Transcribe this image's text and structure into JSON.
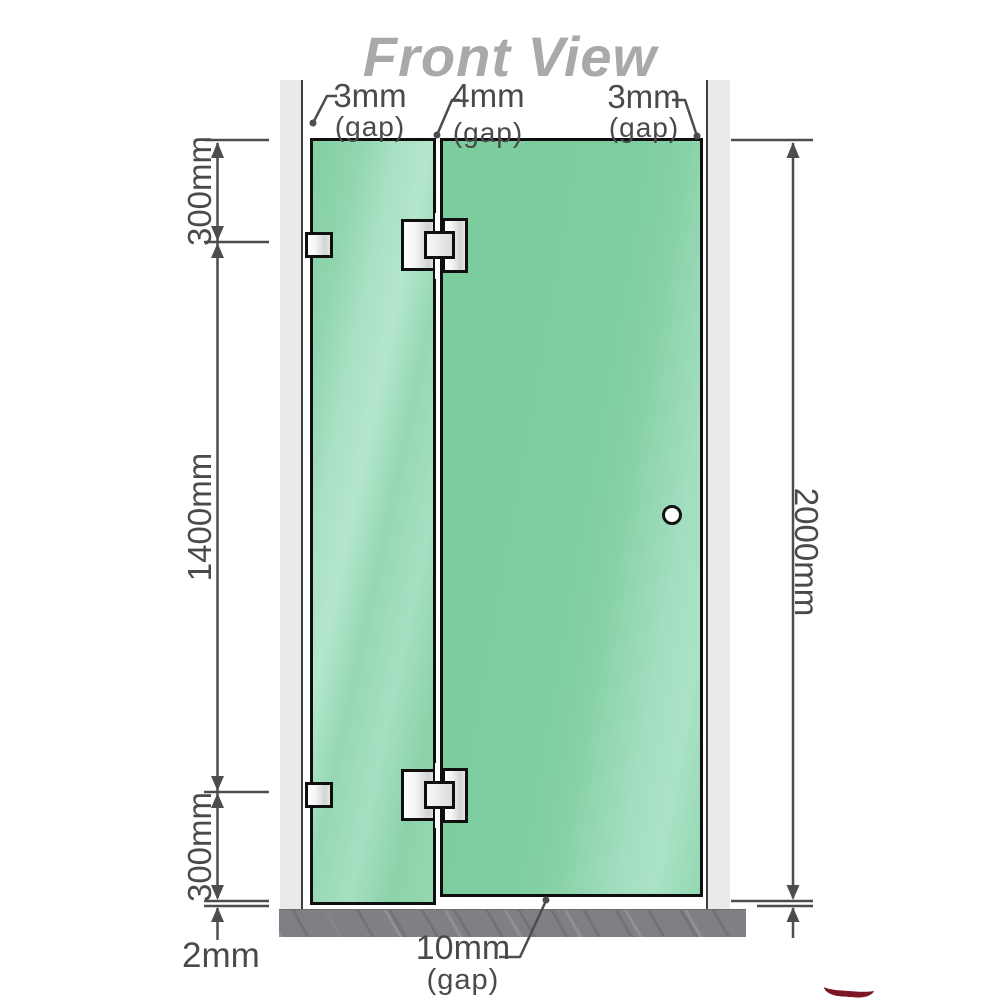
{
  "title": "Front View",
  "gaps": {
    "top_left": {
      "value": "3mm",
      "note": "(gap)"
    },
    "top_middle": {
      "value": "4mm",
      "note": "(gap)"
    },
    "top_right": {
      "value": "3mm",
      "note": "(gap)"
    },
    "bottom": {
      "value": "10mm",
      "note": "(gap)"
    }
  },
  "dimensions": {
    "left_top": "300mm",
    "left_middle": "1400mm",
    "left_bottom": "300mm",
    "floor_clearance": "2mm",
    "right_total": "2000mm"
  },
  "colors": {
    "glass_green": "#7ecd9f",
    "glass_highlight": "#b4e6cc",
    "wall_gray": "#eaeaea",
    "floor_gray": "#7e8083",
    "line_dark": "#4d4d4d",
    "text_dark": "#4a4a4a",
    "title_gray": "#a9a9a9",
    "hardware_border": "#0f0f0f",
    "logo_red": "#7d1727"
  }
}
